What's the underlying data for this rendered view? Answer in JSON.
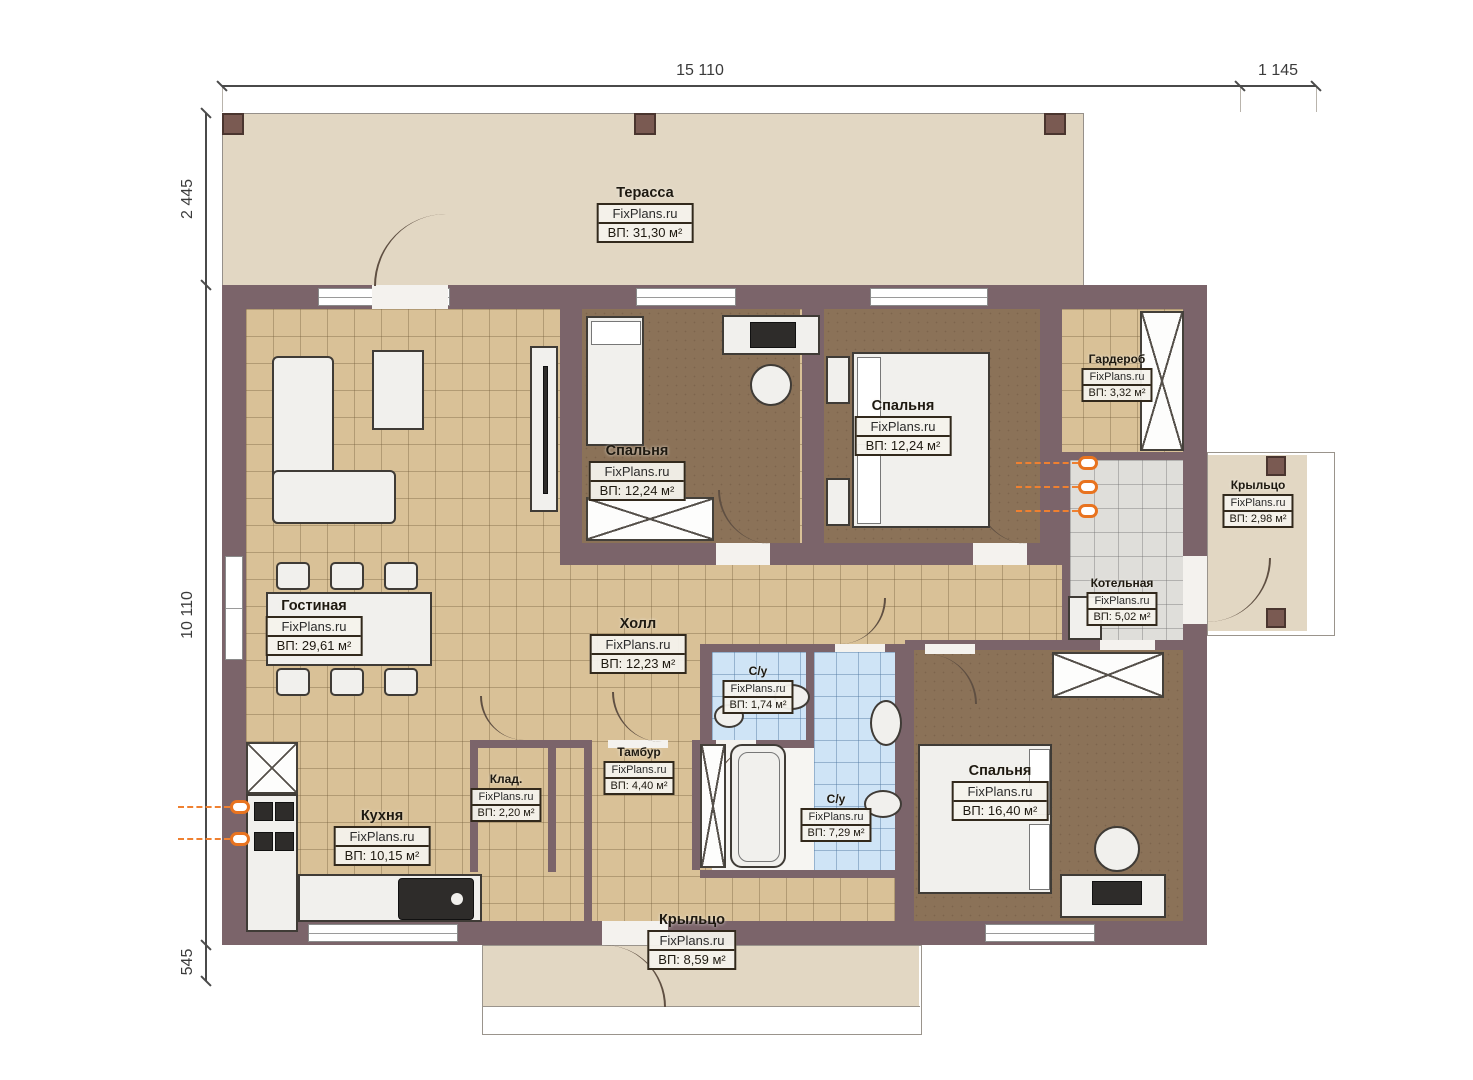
{
  "plan": {
    "watermark": "FixPlans.ru",
    "dimensions": {
      "top_main": "15 110",
      "top_right": "1 145",
      "left_top": "2 445",
      "left_main": "10 110",
      "left_bottom": "545"
    },
    "rooms": [
      {
        "name": "Терасса",
        "watermark": "FixPlans.ru",
        "area": "ВП: 31,30 м²"
      },
      {
        "name": "Спальня",
        "watermark": "FixPlans.ru",
        "area": "ВП: 12,24 м²"
      },
      {
        "name": "Спальня",
        "watermark": "FixPlans.ru",
        "area": "ВП: 12,24 м²"
      },
      {
        "name": "Гардероб",
        "watermark": "FixPlans.ru",
        "area": "ВП: 3,32 м²"
      },
      {
        "name": "Крыльцо",
        "watermark": "FixPlans.ru",
        "area": "ВП: 2,98 м²"
      },
      {
        "name": "Котельная",
        "watermark": "FixPlans.ru",
        "area": "ВП: 5,02 м²"
      },
      {
        "name": "Гостиная",
        "watermark": "FixPlans.ru",
        "area": "ВП: 29,61 м²"
      },
      {
        "name": "Холл",
        "watermark": "FixPlans.ru",
        "area": "ВП: 12,23 м²"
      },
      {
        "name": "С/у",
        "watermark": "FixPlans.ru",
        "area": "ВП: 1,74 м²"
      },
      {
        "name": "С/у",
        "watermark": "FixPlans.ru",
        "area": "ВП: 7,29 м²"
      },
      {
        "name": "Спальня",
        "watermark": "FixPlans.ru",
        "area": "ВП: 16,40 м²"
      },
      {
        "name": "Тамбур",
        "watermark": "FixPlans.ru",
        "area": "ВП: 4,40 м²"
      },
      {
        "name": "Клад.",
        "watermark": "FixPlans.ru",
        "area": "ВП: 2,20 м²"
      },
      {
        "name": "Кухня",
        "watermark": "FixPlans.ru",
        "area": "ВП: 10,15 м²"
      },
      {
        "name": "Крыльцо",
        "watermark": "FixPlans.ru",
        "area": "ВП: 8,59 м²"
      }
    ],
    "colors": {
      "wall": "#7b646a",
      "floor_tile_tan": "#d9c197",
      "floor_bedroom": "#8b7258",
      "floor_bath": "#cfe4f6",
      "floor_boiler": "#dfdeda",
      "terrace": "#e2d7c3",
      "radiator_accent": "#e8731f",
      "label_bg": "#f4f2ec"
    }
  }
}
